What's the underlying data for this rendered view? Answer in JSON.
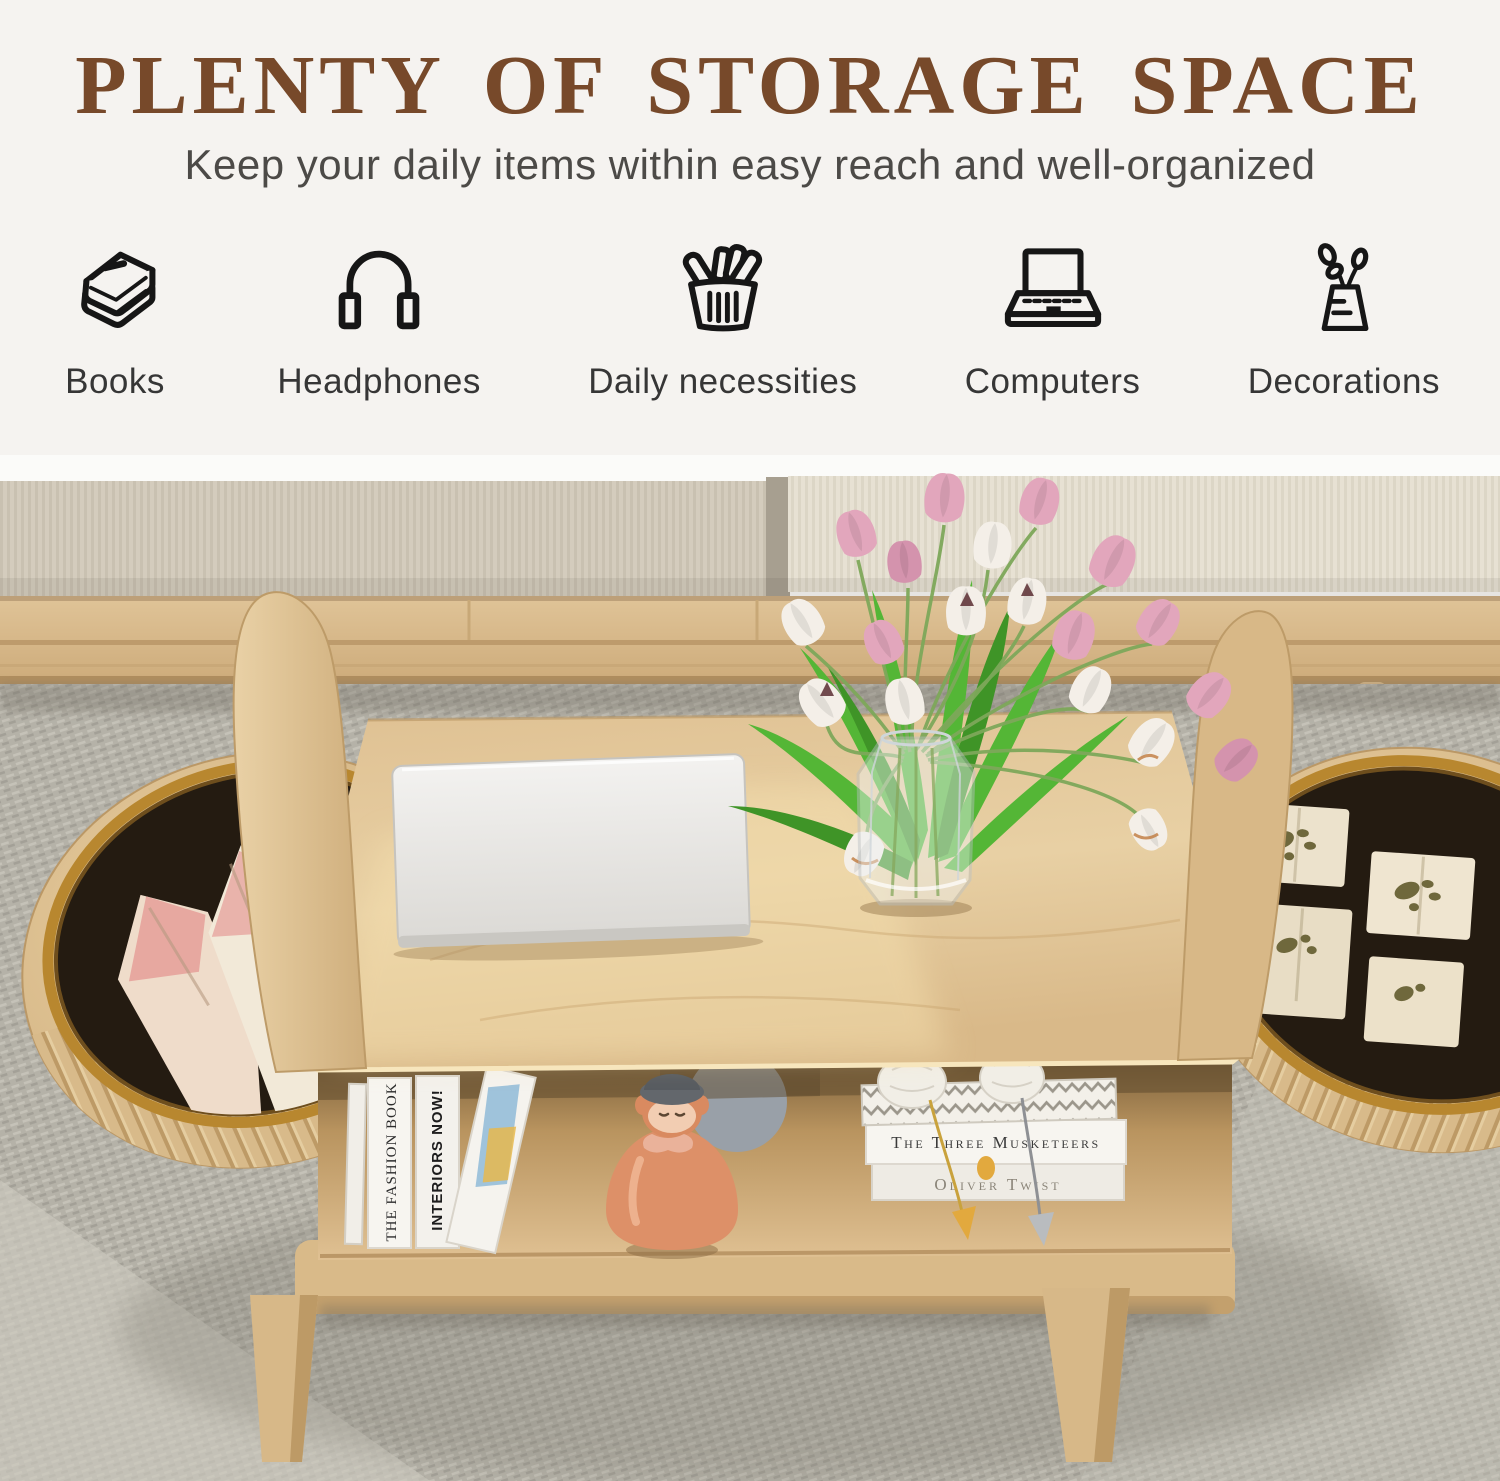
{
  "colors": {
    "title_brown": "#77492a",
    "subtitle_gray": "#4c4a47",
    "icon_ink": "#161616",
    "oak_wood": "#ddbf92",
    "gold_rim": "#b8872f",
    "bin_interior": "#241b11",
    "cushion_beige": "#d6cfc0",
    "carpet_gray": "#b5b2a8",
    "tulip_pink": "#e2a6bc",
    "tulip_white": "#f4efe8",
    "doll_orange": "#dd9068"
  },
  "header": {
    "title": "PLENTY OF STORAGE SPACE",
    "subtitle": "Keep your daily items within easy reach and well-organized",
    "features": [
      {
        "icon": "books-icon",
        "label": "Books"
      },
      {
        "icon": "headphones-icon",
        "label": "Headphones"
      },
      {
        "icon": "basket-icon",
        "label": "Daily necessities"
      },
      {
        "icon": "laptop-icon",
        "label": "Computers"
      },
      {
        "icon": "vase-icon",
        "label": "Decorations"
      }
    ]
  },
  "photo": {
    "caption": "Oval oak coffee table with round open storage ends, laptop, tulip vase, books and figurine in a living room",
    "left_shelf_books": [
      "THE FASHION BOOK",
      "INTERIORS NOW!"
    ],
    "right_shelf_books": [
      "The Three Musketeers",
      "Oliver Twist"
    ]
  }
}
